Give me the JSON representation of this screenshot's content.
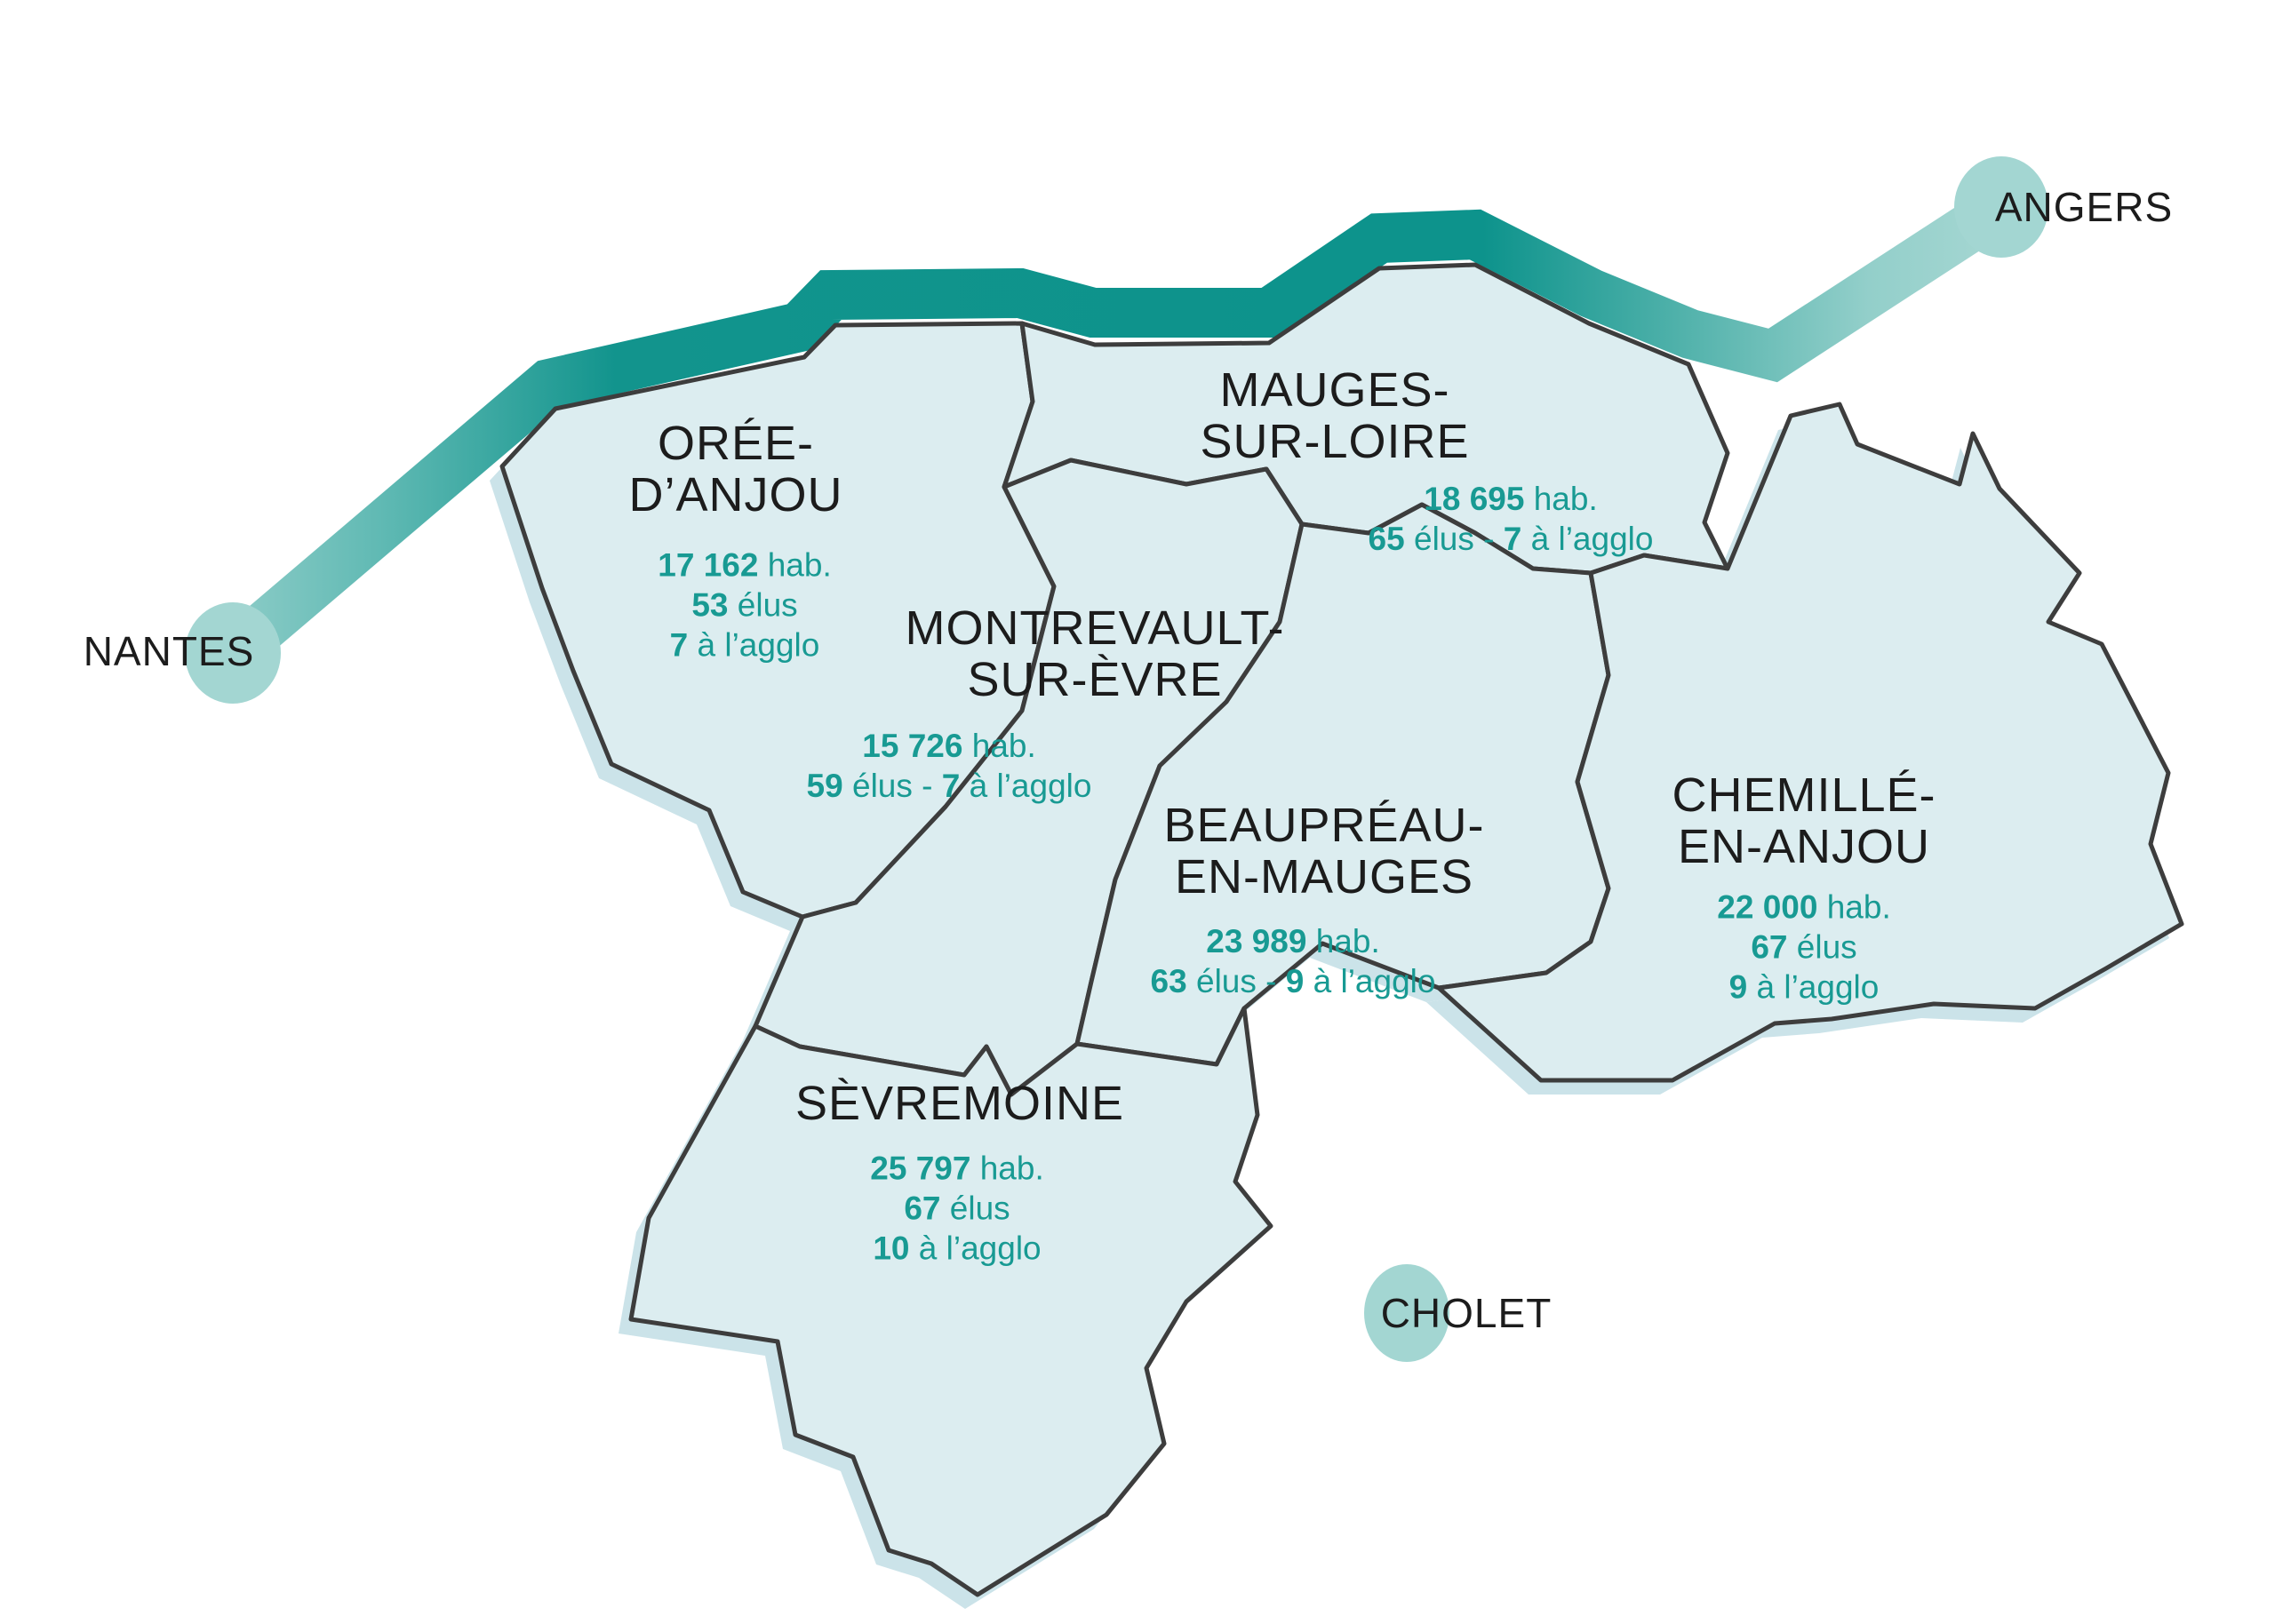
{
  "colors": {
    "background": "#FFFFFF",
    "river_dark": "#0D938C",
    "river_pale": "#A9D8D4",
    "city_circle": "#A3D6D2",
    "region_fill": "#DCEDF0",
    "region_border": "#3D3D3D",
    "shadow": "#CBE3E9",
    "teal_text": "#189A93",
    "black_text": "#1C1C1C"
  },
  "cities": [
    {
      "id": "nantes",
      "name": "NANTES"
    },
    {
      "id": "angers",
      "name": "ANGERS"
    },
    {
      "id": "cholet",
      "name": "CHOLET"
    }
  ],
  "regions": [
    {
      "id": "oree-danjou",
      "name_lines": [
        "ORÉE-",
        "D’ANJOU"
      ],
      "stats": [
        [
          {
            "t": "17 162",
            "b": true
          },
          {
            "t": " hab.",
            "b": false
          }
        ],
        [
          {
            "t": "53",
            "b": true
          },
          {
            "t": " élus",
            "b": false
          }
        ],
        [
          {
            "t": "7",
            "b": true
          },
          {
            "t": " à l’agglo",
            "b": false
          }
        ]
      ]
    },
    {
      "id": "mauges-sur-loire",
      "name_lines": [
        "MAUGES-",
        "SUR-LOIRE"
      ],
      "stats": [
        [
          {
            "t": "18 695",
            "b": true
          },
          {
            "t": " hab.",
            "b": false
          }
        ],
        [
          {
            "t": "65",
            "b": true
          },
          {
            "t": " élus - ",
            "b": false
          },
          {
            "t": "7",
            "b": true
          },
          {
            "t": " à l’agglo",
            "b": false
          }
        ]
      ]
    },
    {
      "id": "montrevault-sur-evre",
      "name_lines": [
        "MONTREVAULT-",
        "SUR-ÈVRE"
      ],
      "stats": [
        [
          {
            "t": "15 726",
            "b": true
          },
          {
            "t": " hab.",
            "b": false
          }
        ],
        [
          {
            "t": "59",
            "b": true
          },
          {
            "t": " élus - ",
            "b": false
          },
          {
            "t": "7",
            "b": true
          },
          {
            "t": " à l’agglo",
            "b": false
          }
        ]
      ]
    },
    {
      "id": "beaupreau-en-mauges",
      "name_lines": [
        "BEAUPRÉAU-",
        "EN-MAUGES"
      ],
      "stats": [
        [
          {
            "t": "23 989",
            "b": true
          },
          {
            "t": " hab.",
            "b": false
          }
        ],
        [
          {
            "t": "63",
            "b": true
          },
          {
            "t": " élus - ",
            "b": false
          },
          {
            "t": "9",
            "b": true
          },
          {
            "t": " à l’agglo",
            "b": false
          }
        ]
      ]
    },
    {
      "id": "chemille-en-anjou",
      "name_lines": [
        "CHEMILLÉ-",
        "EN-ANJOU"
      ],
      "stats": [
        [
          {
            "t": "22 000",
            "b": true
          },
          {
            "t": " hab.",
            "b": false
          }
        ],
        [
          {
            "t": "67",
            "b": true
          },
          {
            "t": " élus",
            "b": false
          }
        ],
        [
          {
            "t": "9",
            "b": true
          },
          {
            "t": " à l’agglo",
            "b": false
          }
        ]
      ]
    },
    {
      "id": "sevremoine",
      "name_lines": [
        "SÈVREMOINE"
      ],
      "stats": [
        [
          {
            "t": "25 797",
            "b": true
          },
          {
            "t": " hab.",
            "b": false
          }
        ],
        [
          {
            "t": "67",
            "b": true
          },
          {
            "t": " élus",
            "b": false
          }
        ],
        [
          {
            "t": "10",
            "b": true
          },
          {
            "t": " à l’agglo",
            "b": false
          }
        ]
      ]
    }
  ]
}
